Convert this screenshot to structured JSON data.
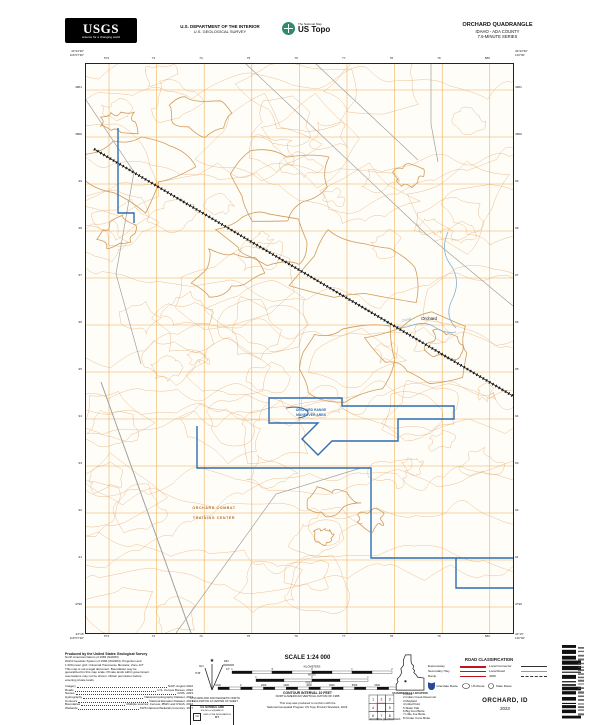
{
  "header": {
    "usgs_logo_text": "USGS",
    "usgs_tagline": "science for a changing world",
    "agency_line1": "U.S. DEPARTMENT OF THE INTERIOR",
    "agency_line2": "U.S. GEOLOGICAL SURVEY",
    "ustopo_small": "The National Map",
    "ustopo_large": "US Topo",
    "quad_title": "ORCHARD QUADRANGLE",
    "quad_subtitle1": "IDAHO - ADA COUNTY",
    "quad_subtitle2": "7.5-MINUTE SERIES"
  },
  "map": {
    "corners": {
      "tl_lat": "43°22'30\"",
      "tl_lon": "116°07'30\"",
      "tr_lat": "43°22'30\"",
      "tr_lon": "116°00'",
      "bl_lat": "43°15'",
      "bl_lon": "116°07'30\"",
      "br_lat": "43°15'",
      "br_lon": "116°00'"
    },
    "grid": {
      "top_eastings": [
        "572",
        "73",
        "74",
        "75",
        "76",
        "77",
        "78",
        "79",
        "580"
      ],
      "bottom_eastings": [
        "572",
        "73",
        "74",
        "75",
        "76",
        "77",
        "78",
        "79",
        "580"
      ],
      "left_northings": [
        "4801",
        "4800",
        "99",
        "98",
        "97",
        "96",
        "95",
        "94",
        "93",
        "92",
        "91",
        "4790"
      ],
      "right_northings": [
        "4801",
        "4800",
        "99",
        "98",
        "97",
        "96",
        "95",
        "94",
        "93",
        "92",
        "91",
        "4790"
      ]
    },
    "labels": {
      "orchard": "Orchard",
      "training_area_line1": "ORCHARD RANGE",
      "training_area_line2": "MANEUVER AREA",
      "octc_line1": "ORCHARD COMBAT",
      "octc_line2": "TRAINING CENTER",
      "canal": "Canal"
    },
    "colors": {
      "contour": "#E2A96E",
      "index_contour": "#C8893E",
      "grid": "#EBA43F",
      "boundary": "#2E6DB4",
      "water": "#7FB3D9",
      "railroad": "#111111",
      "road": "#A0A0A0"
    }
  },
  "footer": {
    "credits_title": "Produced by the United States Geological Survey",
    "credits_lines": [
      "North American Datum of 1983 (NAD83)",
      "World Geodetic System of 1984 (WGS84). Projection and",
      "1 000-meter grid: Universal Transverse Mercator, Zone 11T",
      "This map is not a legal document. Boundaries may be",
      "generalized for this map scale. Private lands within government",
      "reservations may not be shown. Obtain permission before",
      "entering private lands."
    ],
    "sources": [
      {
        "name": "Imagery",
        "value": "NAIP, August 2022"
      },
      {
        "name": "Roads",
        "value": "U.S. Census Bureau, 2022"
      },
      {
        "name": "Names",
        "value": "GNIS, 2023"
      },
      {
        "name": "Hydrography",
        "value": "National Hydrography Dataset, 2023"
      },
      {
        "name": "Contours",
        "value": "National Elevation Dataset, 2023"
      },
      {
        "name": "Boundaries",
        "value": "Multiple sources; Census, IBWC and USGS, 2022"
      },
      {
        "name": "Wetlands",
        "value": "FWS National Wetlands Inventory, 1977"
      }
    ],
    "declination": {
      "star": "★",
      "gn_label": "GN",
      "gn_value": "0°46'",
      "mn_label": "MN",
      "mn_value": "13°",
      "caption_line1": "UTM GRID AND 2023 MAGNETIC NORTH",
      "caption_line2": "DECLINATION AT CENTER OF SHEET"
    },
    "usng": {
      "title": "U.S. NATIONAL GRID",
      "subtitle": "100,000-m SQUARE ID",
      "square_id": "NJ",
      "zone_label": "GRID ZONE DESIGNATION",
      "zone": "11T"
    },
    "scale": {
      "label": "SCALE 1:24 000",
      "km_label": "KILOMETERS",
      "km_ticks": [
        "1",
        ".5",
        "0",
        "1",
        "2"
      ],
      "miles_label": "MILES",
      "miles_ticks": [
        "1",
        "0",
        "1"
      ],
      "feet_label": "FEET",
      "feet_ticks": [
        "1000",
        "0",
        "1000",
        "2000",
        "3000",
        "4000",
        "5000",
        "6000",
        "7000"
      ],
      "contour_line1": "CONTOUR INTERVAL 10 FEET",
      "contour_line2": "NORTH AMERICAN VERTICAL DATUM OF 1988",
      "standard_line1": "This map was produced to conform with the",
      "standard_line2": "National Geospatial Program US Topo Product Standard, 2023."
    },
    "location_caption": "QUADRANGLE LOCATION",
    "adjoining": {
      "caption": "ADJOINING QUADRANGLES",
      "names": [
        "Mora",
        "Indian Creek Reservoir",
        "Mayfield",
        "Initial Point",
        "Slater Flat",
        "Big Foot Butte",
        "Little Joe Butte",
        "Cinder Cone Butte"
      ]
    },
    "road_classification": {
      "title": "ROAD CLASSIFICATION",
      "rows": [
        {
          "left": "Expressway",
          "right": "Local Connector"
        },
        {
          "left": "Secondary Hwy",
          "right": "Local Road"
        },
        {
          "left": "Ramp",
          "right": "4WD"
        }
      ],
      "routes": [
        "Interstate Route",
        "US Route",
        "State Route"
      ]
    },
    "map_title": "ORCHARD, ID",
    "year": "2023"
  }
}
